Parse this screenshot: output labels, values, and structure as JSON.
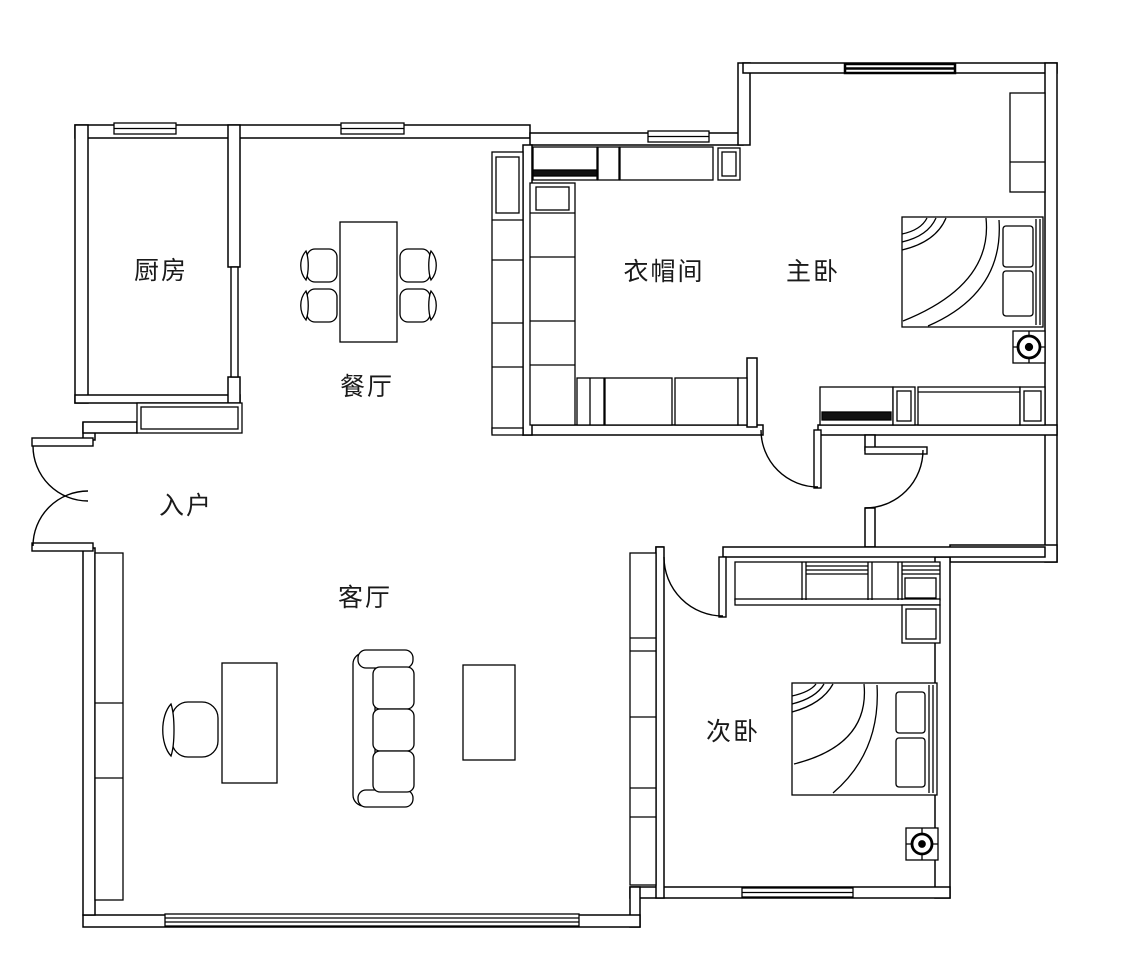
{
  "floorplan": {
    "background": "#ffffff",
    "line_color": "#000000",
    "text_color": "#1a1a1a",
    "rooms": [
      {
        "id": "kitchen",
        "label": "厨房"
      },
      {
        "id": "dining",
        "label": "餐厅"
      },
      {
        "id": "cloakroom",
        "label": "衣帽间"
      },
      {
        "id": "master-bedroom",
        "label": "主卧"
      },
      {
        "id": "entry",
        "label": "入户"
      },
      {
        "id": "living-room",
        "label": "客厅"
      },
      {
        "id": "second-bedroom",
        "label": "次卧"
      }
    ],
    "symbols": [
      {
        "id": "drain-master",
        "name": "floor-drain-symbol"
      },
      {
        "id": "drain-second",
        "name": "floor-drain-symbol"
      }
    ],
    "furniture": [
      "dining-table",
      "dining-chairs",
      "tall-cabinet",
      "wardrobes",
      "shoe-cabinet",
      "master-bed",
      "bedside-cabinet",
      "sofa",
      "desk",
      "desk-chair",
      "tv-cabinet",
      "coffee-table",
      "second-bed",
      "bookshelf",
      "nightstand"
    ]
  }
}
